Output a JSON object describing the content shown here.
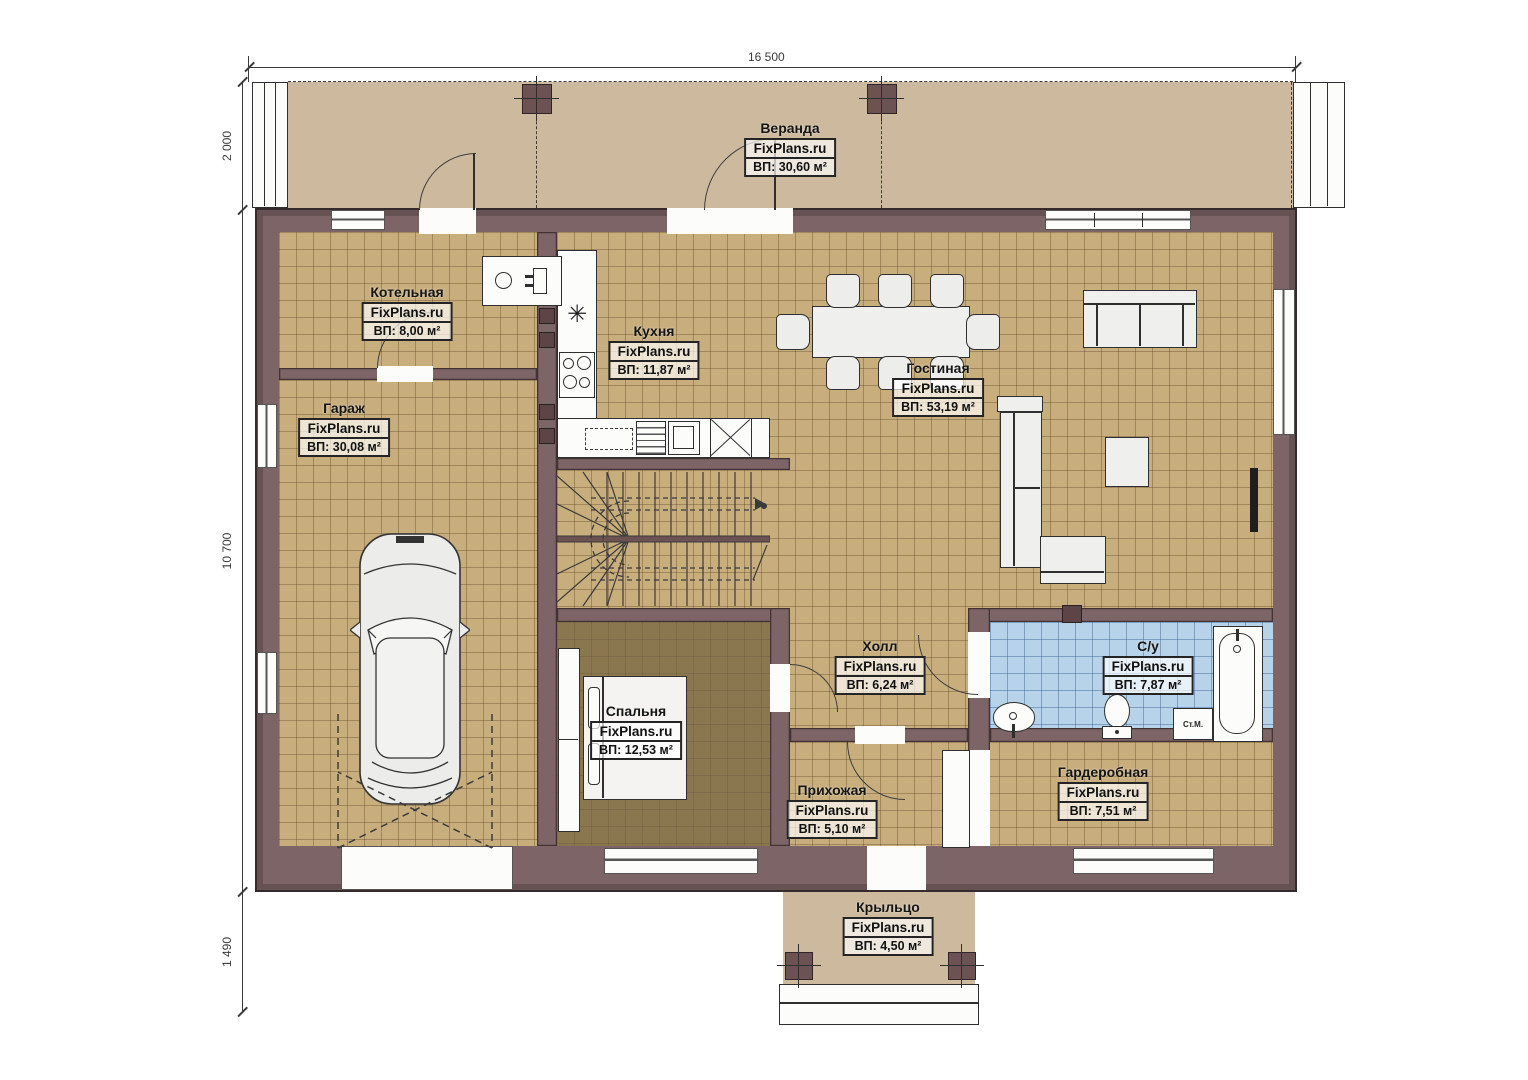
{
  "watermark": "FixPlans.ru",
  "dims": {
    "width_total": "16 500",
    "veranda_depth": "2 000",
    "house_depth": "10 700",
    "porch_depth": "1 490"
  },
  "rooms": [
    {
      "name": "Веранда",
      "area": "ВП: 30,60 м²"
    },
    {
      "name": "Котельная",
      "area": "ВП: 8,00 м²"
    },
    {
      "name": "Кухня",
      "area": "ВП: 11,87 м²"
    },
    {
      "name": "Гостиная",
      "area": "ВП: 53,19 м²"
    },
    {
      "name": "Гараж",
      "area": "ВП: 30,08 м²"
    },
    {
      "name": "Холл",
      "area": "ВП: 6,24 м²"
    },
    {
      "name": "С/у",
      "area": "ВП: 7,87 м²"
    },
    {
      "name": "Спальня",
      "area": "ВП: 12,53 м²"
    },
    {
      "name": "Прихожая",
      "area": "ВП: 5,10 м²"
    },
    {
      "name": "Гардеробная",
      "area": "ВП: 7,51 м²"
    },
    {
      "name": "Крыльцо",
      "area": "ВП: 4,50 м²"
    }
  ],
  "fixtures": {
    "washing_machine": "Ст.М."
  },
  "symbols": {
    "sink": "✳"
  }
}
